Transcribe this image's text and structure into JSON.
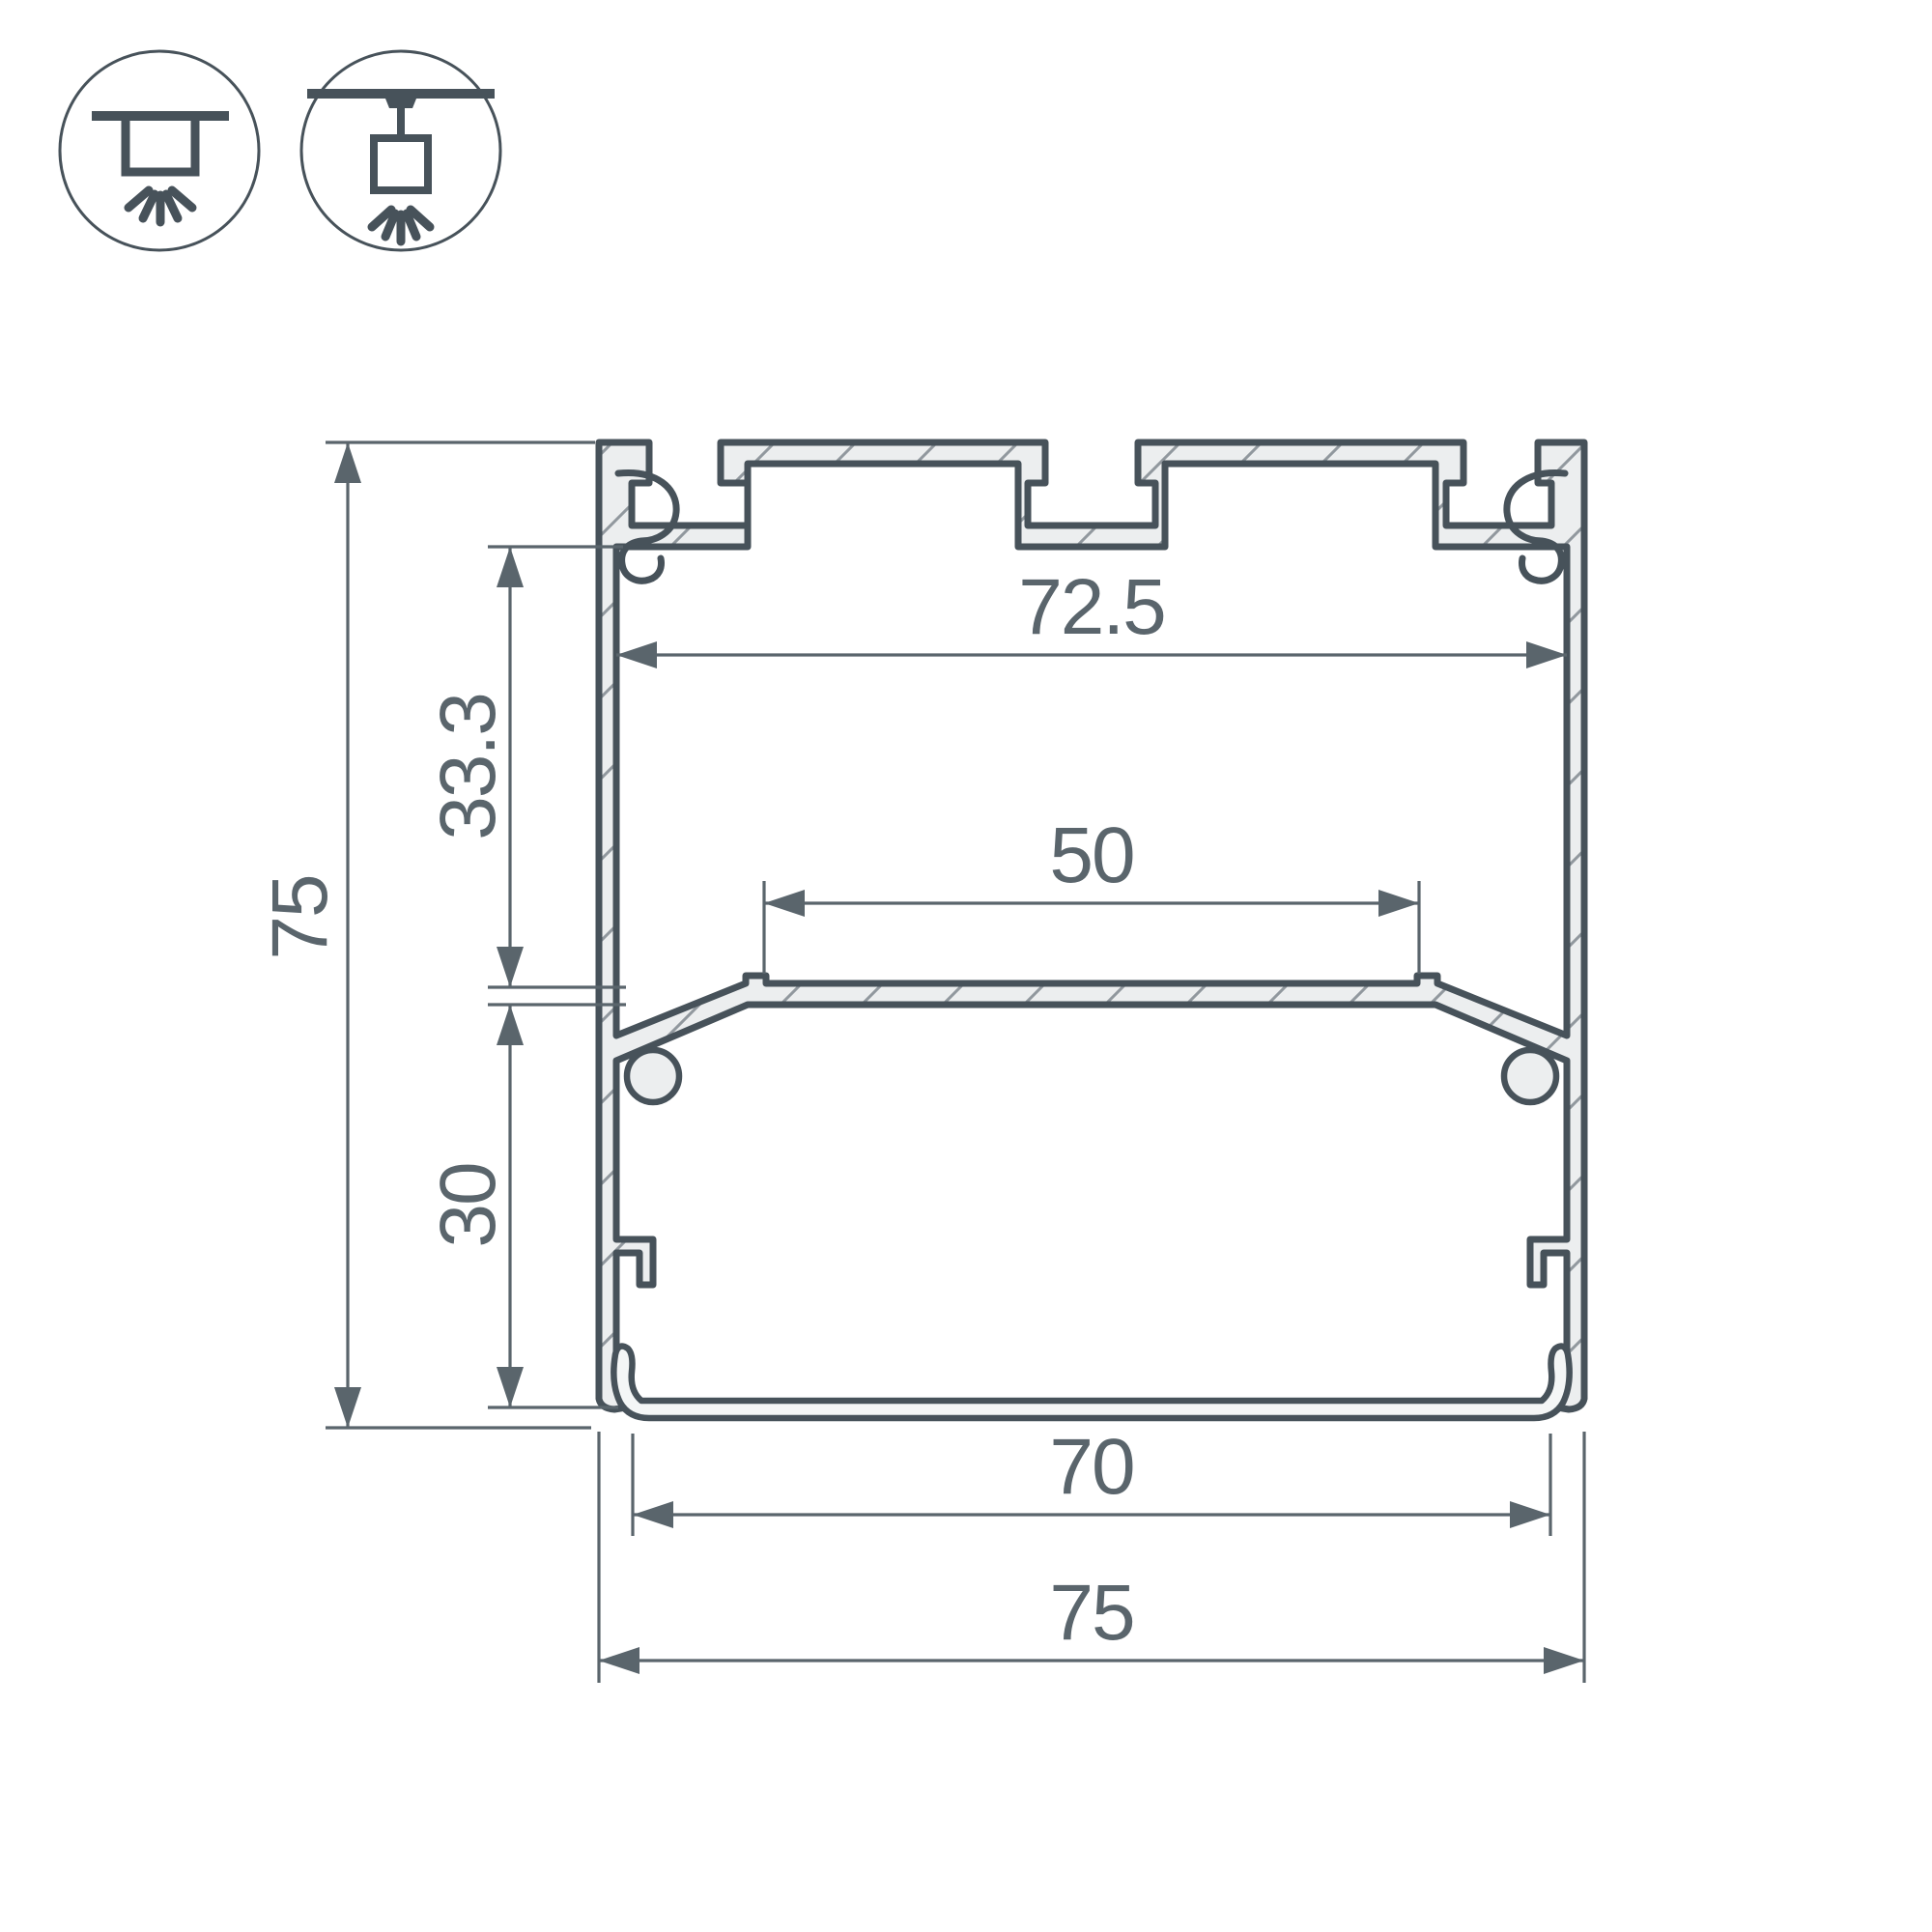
{
  "drawing": {
    "type": "technical-cross-section",
    "subject": "aluminium LED profile cross-section with dimensions",
    "dimensions": {
      "inner_top_width": "72.5",
      "upper_section_height": "33.3",
      "total_height": "75",
      "led_platform_width": "50",
      "lower_section_height": "30",
      "bottom_opening_width": "70",
      "total_width": "75"
    },
    "icons": {
      "surface_mount": "surface-ceiling-mount-light-icon",
      "pendant_mount": "suspended-pendant-light-icon"
    },
    "colors": {
      "line": "#47525A",
      "metal_fill": "#ECEEEF",
      "dimension_line": "#5A656C",
      "text": "#5A656C",
      "background": "#FFFFFF"
    }
  }
}
